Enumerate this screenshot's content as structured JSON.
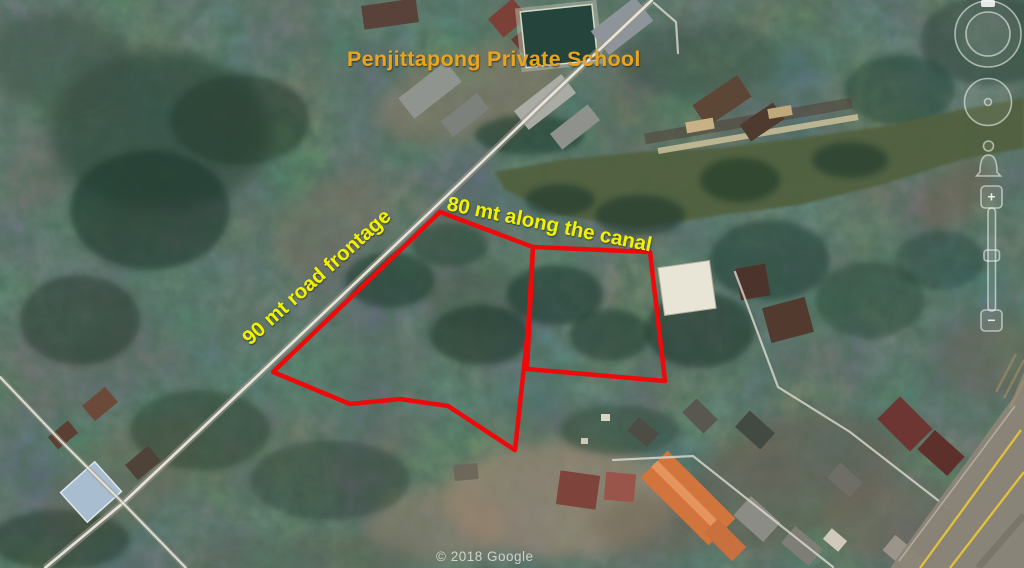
{
  "map": {
    "attribution": "© 2018 Google",
    "labels": {
      "school": "Penjittapong Private School",
      "canal_side": "80 mt along the canal",
      "road_side": "90 mt road frontage"
    },
    "colors": {
      "school_label": "#e8a41e",
      "measure_label": "#f1f106",
      "plot_outline": "#ee0a0a",
      "attribution": "#e0e0e0"
    },
    "land_plots": {
      "left_plot_points": "440,212 533,247 528,330 515,450 448,406 400,399 350,404 273,372",
      "right_plot_points": "533,247 650,252 665,381 527,369"
    }
  },
  "nav": {
    "zoom_in_glyph": "+",
    "zoom_out_glyph": "−"
  }
}
